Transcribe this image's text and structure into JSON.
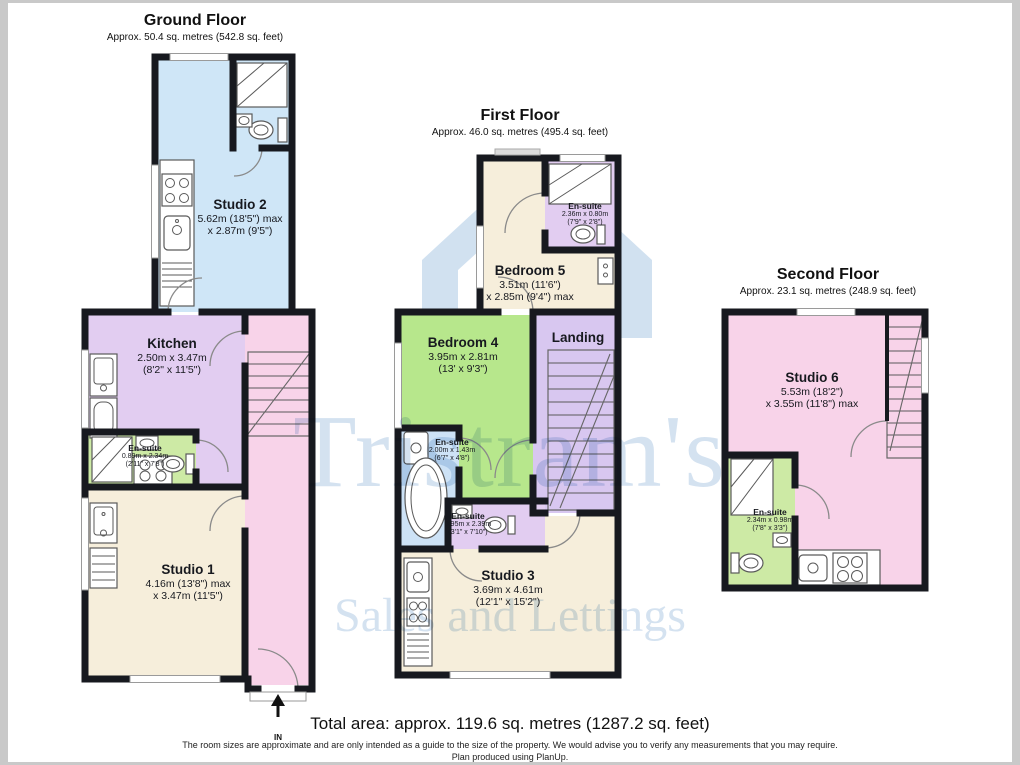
{
  "floors": {
    "ground": {
      "title": "Ground Floor",
      "subtitle": "Approx. 50.4 sq. metres (542.8 sq. feet)",
      "entrance_label": "IN",
      "rooms": {
        "studio2": {
          "name": "Studio 2",
          "dim1": "5.62m (18'5\") max",
          "dim2": "x 2.87m (9'5\")"
        },
        "kitchen": {
          "name": "Kitchen",
          "dim1": "2.50m x 3.47m",
          "dim2": "(8'2\" x 11'5\")"
        },
        "ensuite": {
          "name": "En-suite",
          "dim1": "0.89m x 2.34m",
          "dim2": "(2'11\" x 7'8\")"
        },
        "studio1": {
          "name": "Studio 1",
          "dim1": "4.16m (13'8\") max",
          "dim2": "x 3.47m (11'5\")"
        }
      }
    },
    "first": {
      "title": "First Floor",
      "subtitle": "Approx. 46.0 sq. metres (495.4 sq. feet)",
      "rooms": {
        "ensuite_top": {
          "name": "En-suite",
          "dim1": "2.36m x 0.80m",
          "dim2": "(7'9\" x 2'8\")"
        },
        "bedroom5": {
          "name": "Bedroom 5",
          "dim1": "3.51m (11'6\")",
          "dim2": "x 2.85m (9'4\") max"
        },
        "bedroom4": {
          "name": "Bedroom 4",
          "dim1": "3.95m x 2.81m",
          "dim2": "(13' x 9'3\")"
        },
        "landing": {
          "name": "Landing"
        },
        "ensuite_mid": {
          "name": "En-suite",
          "dim1": "2.00m x 1.43m",
          "dim2": "(6'7\" x 4'8\")"
        },
        "ensuite_low": {
          "name": "En-suite",
          "dim1": "0.95m x 2.39m",
          "dim2": "(3'1\" x 7'10\")"
        },
        "studio3": {
          "name": "Studio 3",
          "dim1": "3.69m x 4.61m",
          "dim2": "(12'1\" x 15'2\")"
        }
      }
    },
    "second": {
      "title": "Second Floor",
      "subtitle": "Approx. 23.1 sq. metres (248.9 sq. feet)",
      "rooms": {
        "studio6": {
          "name": "Studio 6",
          "dim1": "5.53m (18'2\")",
          "dim2": "x 3.55m (11'8\") max"
        },
        "ensuite": {
          "name": "En-suite",
          "dim1": "2.34m x 0.98m",
          "dim2": "(7'8\" x 3'3\")"
        }
      }
    }
  },
  "watermark": {
    "line1": "Tristram's",
    "line2": "Sales and Lettings"
  },
  "footer": {
    "total": "Total area: approx. 119.6 sq. metres (1287.2 sq. feet)",
    "disclaimer": "The room sizes are approximate and are only intended as a guide to the size of the property. We would advise you to verify any measurements that you may require.",
    "producer": "Plan produced using PlanUp."
  },
  "colors": {
    "walls": "#17191f",
    "studio_blue": "#cfe6f7",
    "cream": "#f6eedb",
    "lavender": "#e2cdf1",
    "pink": "#f8d3e9",
    "ensuite_green": "#cdeaa5",
    "bedroom_green": "#b7e78c",
    "landing_lavender": "#d8c7f0",
    "ensuite_blue": "#cde2f6",
    "watermark_blue": "#aac5e2"
  }
}
